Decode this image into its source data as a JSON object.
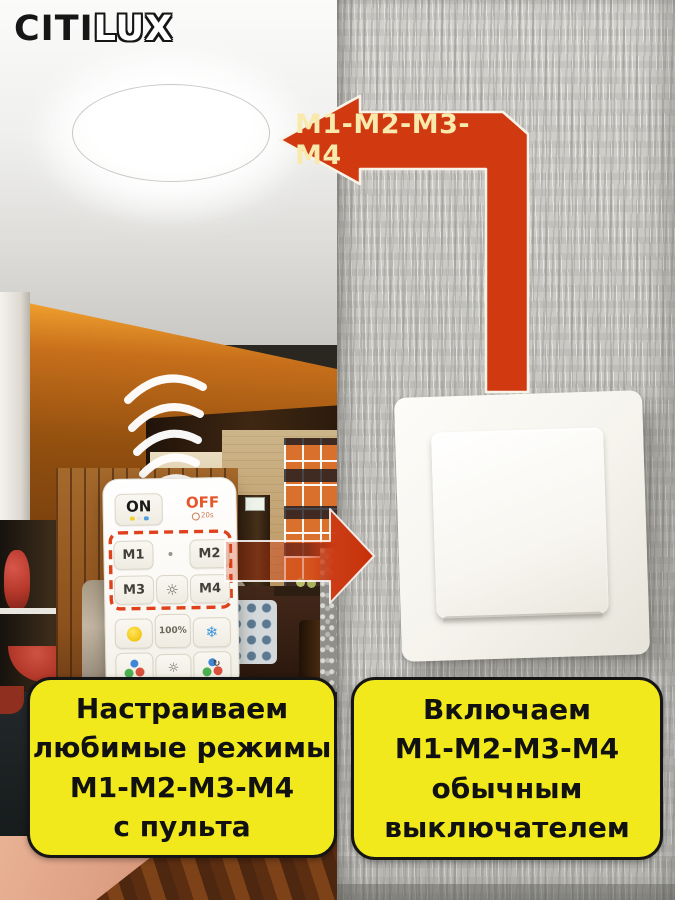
{
  "brand": {
    "citi": "CITI",
    "lux": "LUX"
  },
  "arrow_banner": {
    "label": "М1-М2-М3-М4"
  },
  "remote": {
    "on": "ON",
    "off": "OFF",
    "off_sub": "20s",
    "m1": "M1",
    "m2": "M2",
    "m3": "M3",
    "m4": "M4",
    "brightness": "100%",
    "icons": {
      "night_light_glyph": "☼",
      "mode_sun_glyph": "☼",
      "cool_glyph": "❄",
      "cycle_glyph": "↻"
    }
  },
  "captions": {
    "left": "Настраиваем\nлюбимые режимы\nМ1-М2-М3-М4\nс пульта",
    "right": "Включаем\nМ1-М2-М3-М4\nобычным\nвыключателем"
  },
  "colors": {
    "arrow_red": "#d13a10",
    "caption_yellow": "#f1e91c",
    "caption_border": "#151515",
    "off_orange": "#e4552a",
    "arrow_text_yellow": "#f8e9ad",
    "wall_gray": "#cbcac6"
  }
}
